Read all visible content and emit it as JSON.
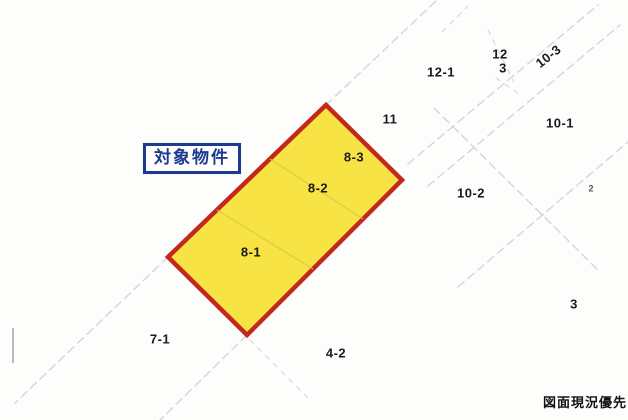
{
  "map": {
    "target_label": "対象物件",
    "footer_note": "図面現況優先",
    "highlight_sections": [
      "8-1",
      "8-2",
      "8-3"
    ],
    "parcels": [
      {
        "label": "8-1"
      },
      {
        "label": "8-2"
      },
      {
        "label": "8-3"
      },
      {
        "label": "11"
      },
      {
        "label": "12-1"
      },
      {
        "label": "12"
      },
      {
        "label": "3"
      },
      {
        "label": "10-3"
      },
      {
        "label": "10-1"
      },
      {
        "label": "10-2"
      },
      {
        "label": "3"
      },
      {
        "label": "7-1"
      },
      {
        "label": "4-2"
      },
      {
        "label": "2"
      }
    ]
  },
  "colors": {
    "highlight_fill": "#f8e345",
    "highlight_border": "#c3281a",
    "label_box_blue": "#1d3a8e",
    "survey_line_gray": "#d3d5da",
    "text_black": "#1b1b1b"
  }
}
